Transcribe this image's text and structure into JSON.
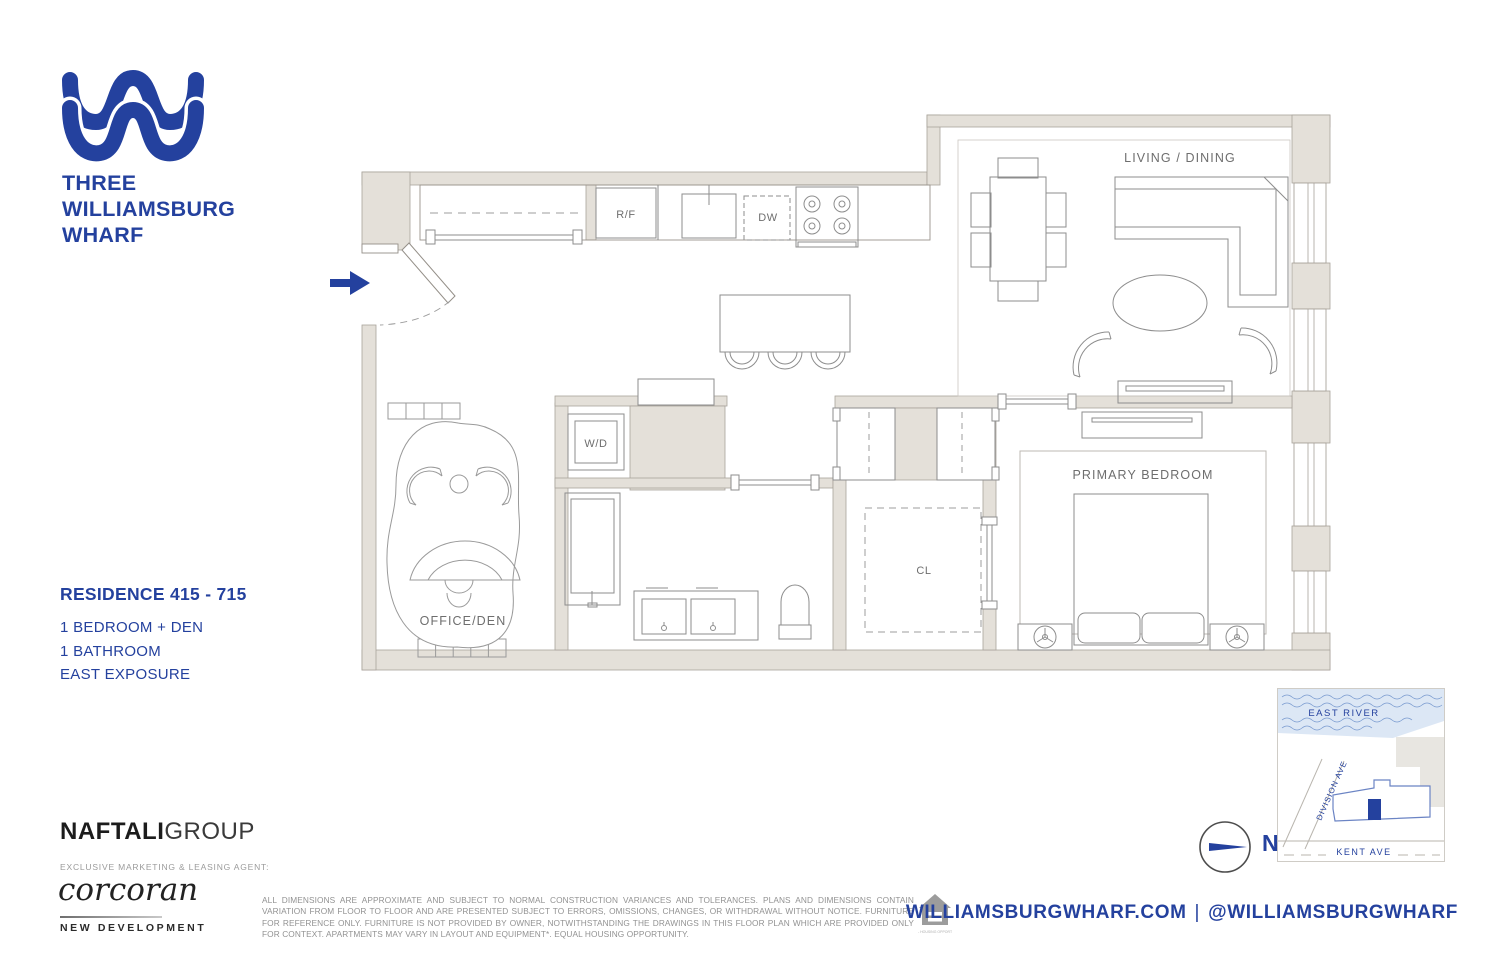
{
  "brand": {
    "logo_icon": "waves-logo-icon",
    "name_lines": [
      "THREE",
      "WILLIAMSBURG",
      "WHARF"
    ],
    "accent_color": "#24419E"
  },
  "residence": {
    "title": "RESIDENCE 415 - 715",
    "specs": [
      "1 BEDROOM + DEN",
      "1 BATHROOM",
      "EAST EXPOSURE"
    ]
  },
  "floor_plan": {
    "labels": {
      "living_dining": "LIVING / DINING",
      "primary_bedroom": "PRIMARY BEDROOM",
      "office_den": "OFFICE/DEN",
      "washer_dryer": "W/D",
      "closet": "CL",
      "refrigerator": "R/F",
      "dishwasher": "DW"
    },
    "wall_fill_color": "#E4E0D9",
    "entry_arrow_color": "#24419E"
  },
  "site_map": {
    "river_label": "EAST RIVER",
    "division_label": "DIVISION AVE",
    "kent_label": "KENT AVE",
    "compass_label": "N",
    "water_color": "#DCE7F5",
    "marker_color": "#24419E"
  },
  "footer": {
    "developer_bold": "NAFTALI",
    "developer_light": "GROUP",
    "agent_heading": "EXCLUSIVE MARKETING & LEASING AGENT:",
    "agent_name": "corcoran",
    "agent_division": "NEW DEVELOPMENT",
    "disclaimer": "ALL DIMENSIONS ARE APPROXIMATE AND SUBJECT TO NORMAL CONSTRUCTION VARIANCES AND TOLERANCES. PLANS AND DIMENSIONS CONTAIN VARIATION FROM FLOOR TO FLOOR AND ARE PRESENTED SUBJECT TO ERRORS, OMISSIONS, CHANGES, OR WITHDRAWAL WITHOUT NOTICE. FURNITURE FOR REFERENCE ONLY. FURNITURE IS NOT PROVIDED BY OWNER, NOTWITHSTANDING THE DRAWINGS IN THIS FLOOR PLAN WHICH ARE PROVIDED ONLY FOR CONTEXT. APARTMENTS MAY VARY IN LAYOUT AND EQUIPMENT*. EQUAL HOUSING OPPORTUNITY.",
    "equal_housing_caption": "EQUAL HOUSING OPPORTUNITY",
    "website": "WILLIAMSBURGWHARF.COM",
    "separator": "|",
    "social_handle": "@WILLIAMSBURGWHARF"
  }
}
